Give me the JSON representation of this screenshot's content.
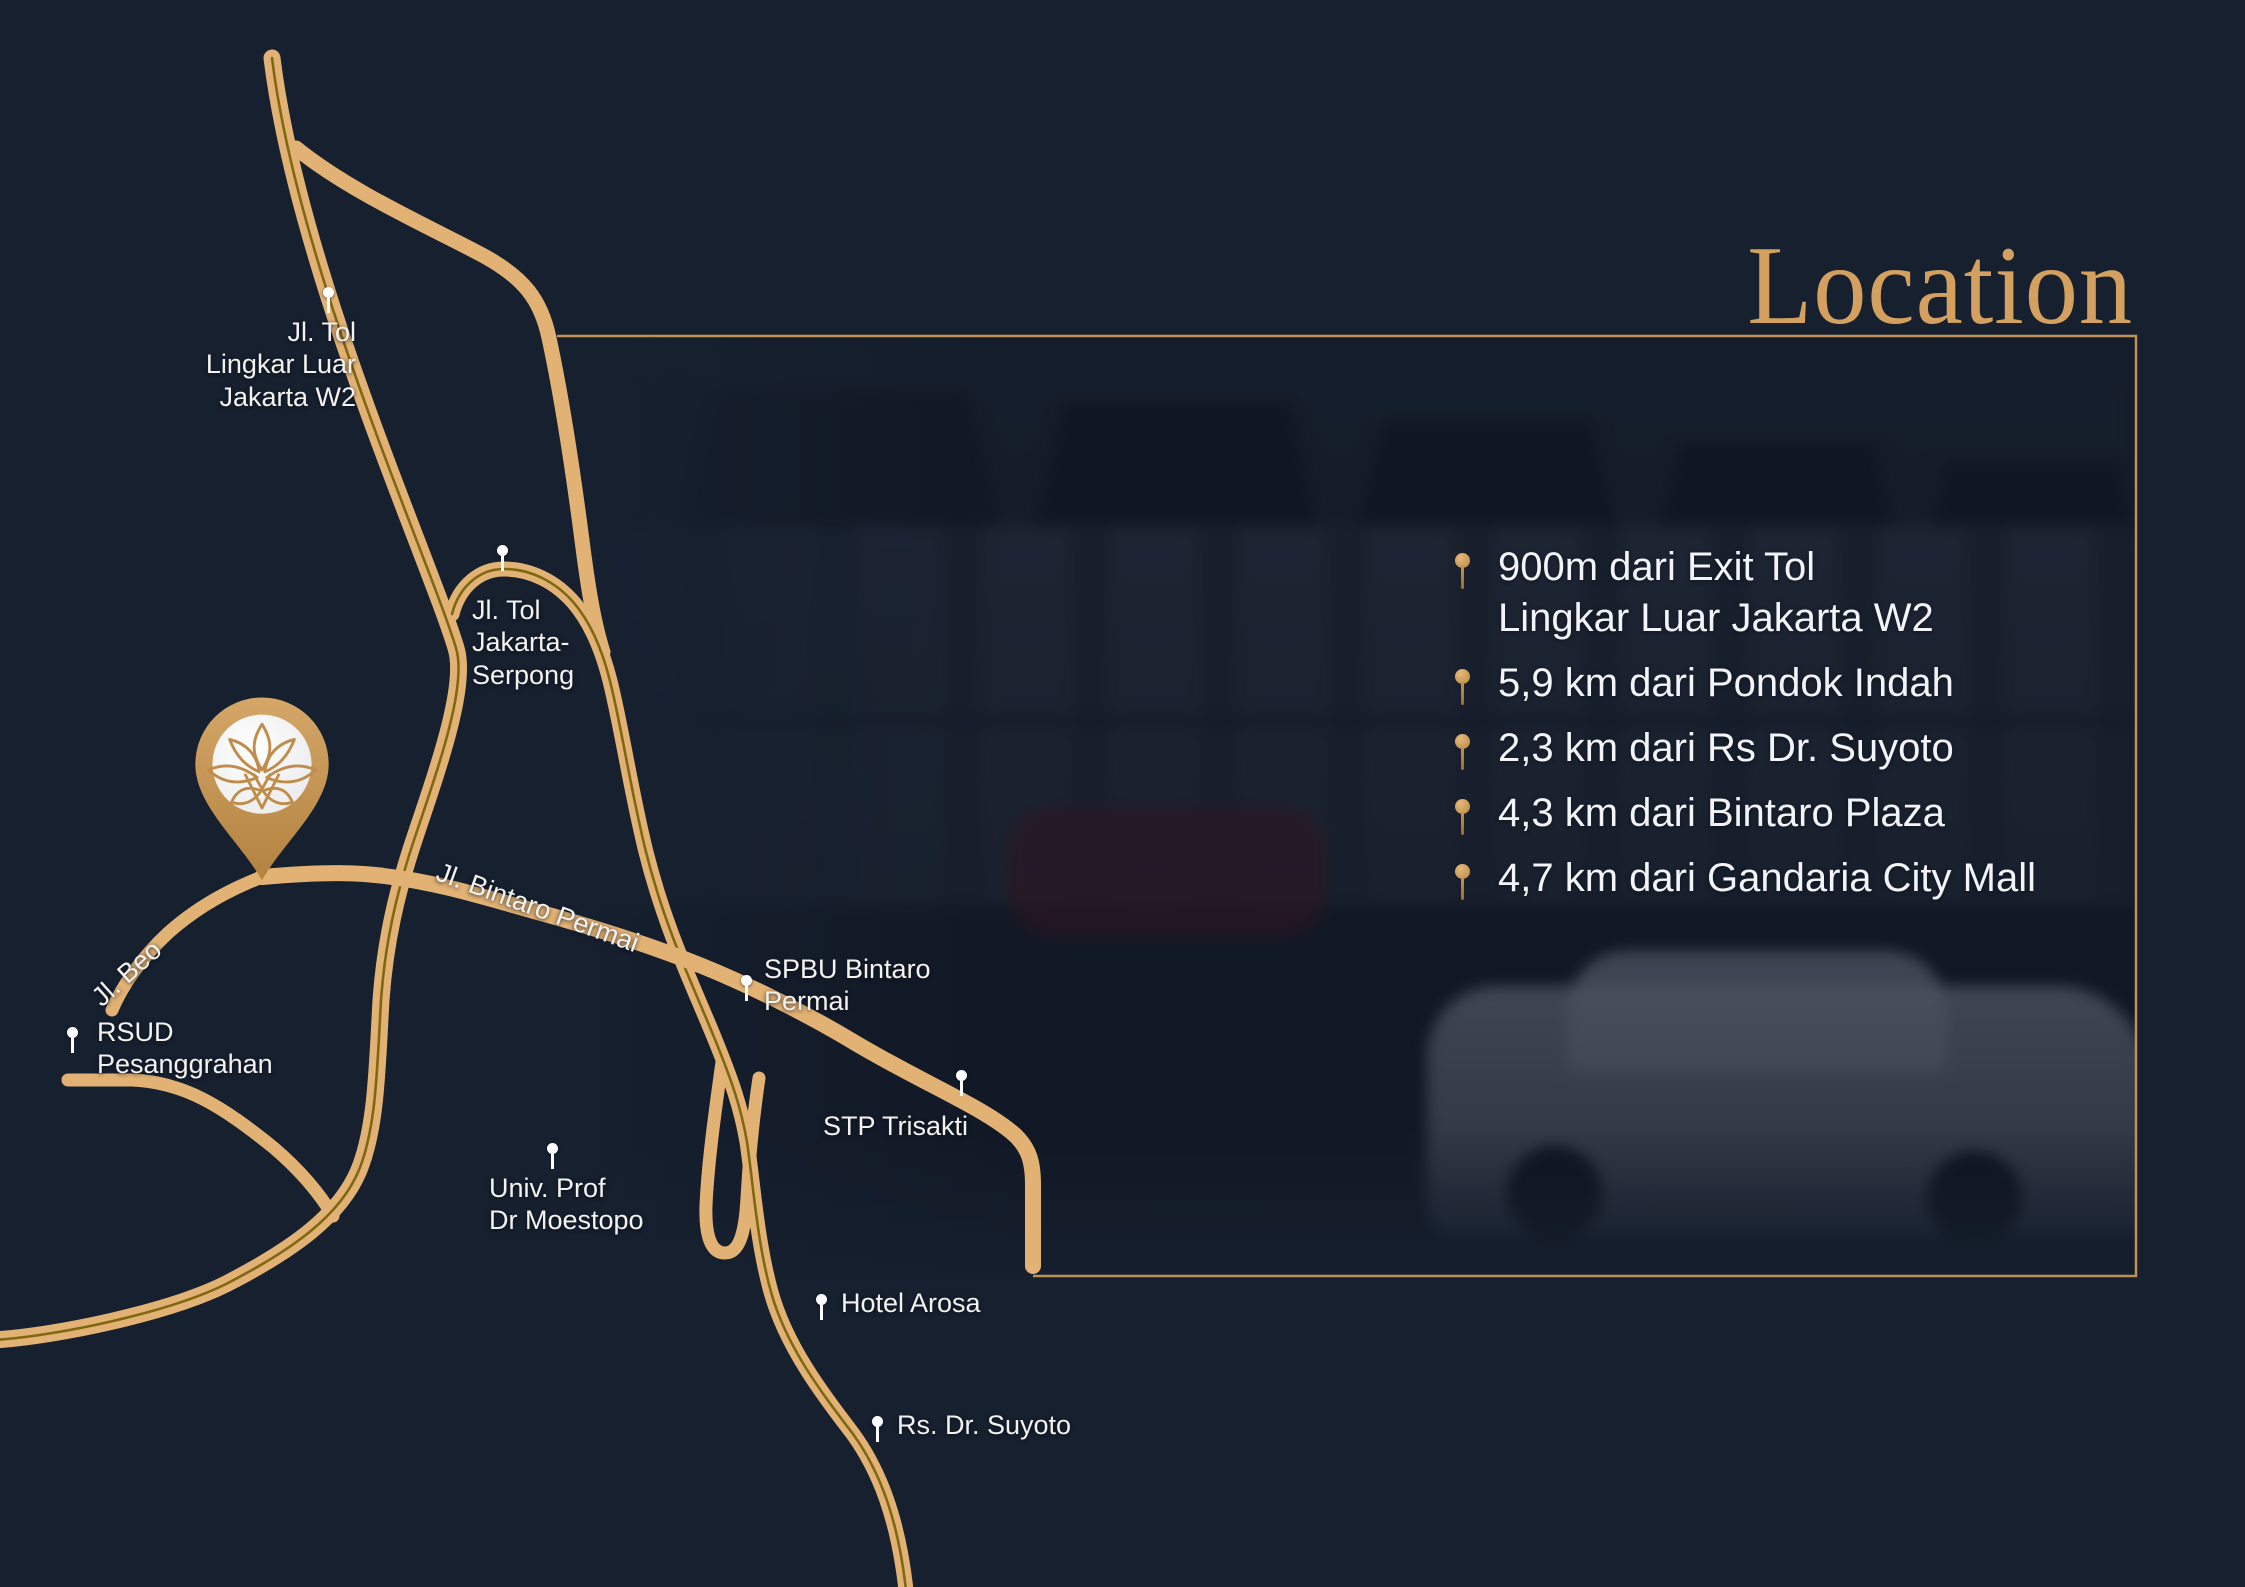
{
  "title": {
    "text": "Location",
    "color": "#d3a05f"
  },
  "distances": {
    "items": [
      {
        "text": "900m dari Exit Tol\nLingkar Luar Jakarta W2"
      },
      {
        "text": "5,9 km dari Pondok Indah"
      },
      {
        "text": "2,3 km dari Rs Dr. Suyoto"
      },
      {
        "text": "4,3 km dari Bintaro Plaza"
      },
      {
        "text": "4,7 km dari Gandaria City Mall"
      }
    ]
  },
  "map": {
    "labels": [
      {
        "id": "tol-lingkar-luar",
        "text": "Jl. Tol\nLingkar Luar\nJakarta W2"
      },
      {
        "id": "tol-jakarta-serpong",
        "text": "Jl. Tol\nJakarta-\nSerpong"
      },
      {
        "id": "jl-beo",
        "text": "Jl. Beo"
      },
      {
        "id": "jl-bintaro-permai",
        "text": "Jl. Bintaro Permai"
      },
      {
        "id": "rsud-pesanggrahan",
        "text": "RSUD\nPesanggrahan"
      },
      {
        "id": "spbu-bintaro-permai",
        "text": "SPBU Bintaro\nPermai"
      },
      {
        "id": "stp-trisakti",
        "text": "STP Trisakti"
      },
      {
        "id": "univ-moestopo",
        "text": "Univ. Prof\nDr Moestopo"
      },
      {
        "id": "hotel-arosa",
        "text": "Hotel Arosa"
      },
      {
        "id": "rs-dr-suyoto",
        "text": "Rs. Dr. Suyoto"
      }
    ],
    "colors": {
      "background": "#16202f",
      "road": "#e2b274",
      "toll_center_line": "#806712",
      "frame": "#bf9257",
      "marker_gold": "#c89a58",
      "label_text": "#f4f2ee"
    }
  }
}
